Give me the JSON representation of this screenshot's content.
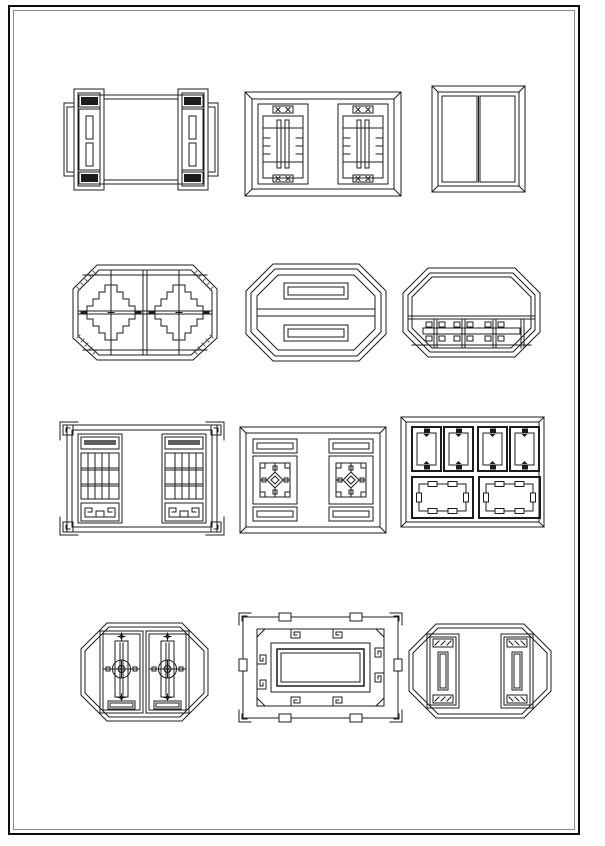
{
  "page": {
    "background": "#ffffff",
    "line_color": "#1c1c1c",
    "line_color_light": "#5f5f5f",
    "frame": {
      "outer_color": "#0d0d0d",
      "inner_color": "#8a8a8a"
    },
    "description": "Catalog sheet of twelve traditional Chinese lattice window CAD line drawings",
    "grid": {
      "rows": 4,
      "cols": 3
    }
  },
  "windows": [
    {
      "id": "w1",
      "row": 1,
      "col": 1,
      "shape": "rectangle-stepped-frame",
      "pattern": "cracked-ice side panels with twin slots and dark tabs",
      "label": "Rectangular window, cracked-ice side panels"
    },
    {
      "id": "w2",
      "row": 1,
      "col": 2,
      "shape": "rectangle",
      "pattern": "vertical slat side panels with small finial ornaments",
      "label": "Rectangular window, slatted side panels"
    },
    {
      "id": "w3",
      "row": 1,
      "col": 3,
      "shape": "rectangle",
      "pattern": "dense floral diamond lattice, two leaves",
      "label": "Double-leaf window, floral lattice"
    },
    {
      "id": "w4",
      "row": 2,
      "col": 1,
      "shape": "octagon",
      "pattern": "stepped fret lattice with hatched corners",
      "label": "Octagonal window, stepped fret lattice"
    },
    {
      "id": "w5",
      "row": 2,
      "col": 2,
      "shape": "octagon",
      "pattern": "two cracked-ice halves with horizontal slot panels",
      "label": "Octagonal window, cracked-ice halves"
    },
    {
      "id": "w6",
      "row": 2,
      "col": 3,
      "shape": "octagon",
      "pattern": "open light with lower fret band",
      "label": "Octagonal window, lower fret band"
    },
    {
      "id": "w7",
      "row": 3,
      "col": 1,
      "shape": "rectangle-corner-brackets",
      "pattern": "grid lattice side panels with meander base",
      "label": "Rectangular window, grid side panels with corner brackets"
    },
    {
      "id": "w8",
      "row": 3,
      "col": 2,
      "shape": "rectangle",
      "pattern": "side panels with central diamond medallion",
      "label": "Rectangular window, diamond medallion side panels"
    },
    {
      "id": "w9",
      "row": 3,
      "col": 3,
      "shape": "rectangle",
      "pattern": "four small upper sashes over two large panels",
      "label": "Six-panel casement window"
    },
    {
      "id": "w10",
      "row": 4,
      "col": 1,
      "shape": "octagon",
      "pattern": "twin doors with circular medallions and slats",
      "label": "Octagonal window, twin medallion doors"
    },
    {
      "id": "w11",
      "row": 4,
      "col": 2,
      "shape": "rectangle-bracketed",
      "pattern": "greek-key band around open center",
      "label": "Rectangular window, greek-key border"
    },
    {
      "id": "w12",
      "row": 4,
      "col": 3,
      "shape": "octagon",
      "pattern": "cracked-ice side panels with vertical slots",
      "label": "Octagonal window, cracked-ice side panels"
    }
  ]
}
